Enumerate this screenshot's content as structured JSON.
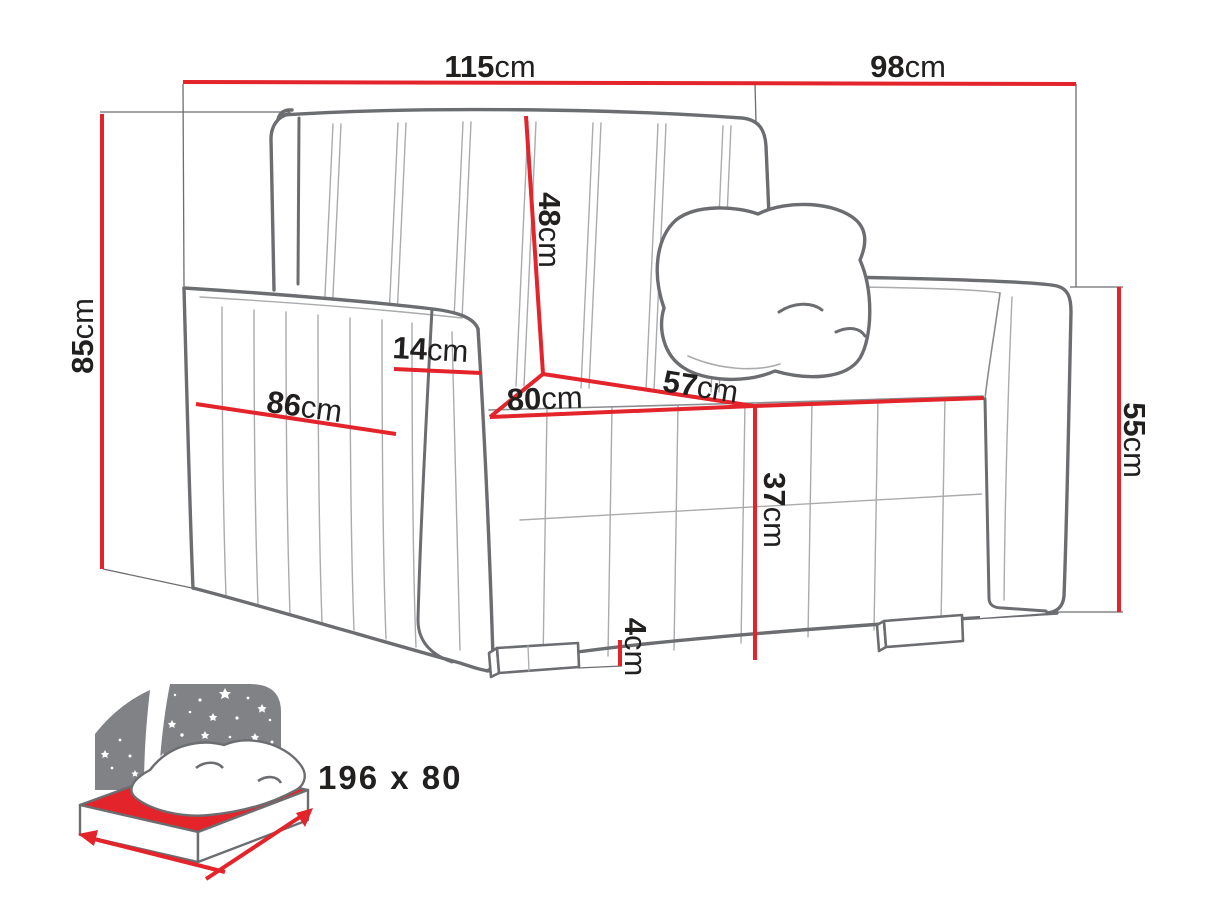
{
  "diagram": {
    "subject": "armchair sofa-bed dimension diagram",
    "unit": "cm",
    "colors": {
      "dimension_red": "#e3242b",
      "outline_gray": "#6b6d70",
      "sketch_gray": "#a9abad",
      "label_black": "#221f1f",
      "icon_gray": "#808285",
      "icon_text_gray": "#77787b"
    },
    "dimensions": {
      "overall_width": {
        "value": "115",
        "unit": "cm"
      },
      "overall_depth": {
        "value": "98",
        "unit": "cm"
      },
      "overall_height": {
        "value": "85",
        "unit": "cm"
      },
      "backrest_height": {
        "value": "48",
        "unit": "cm"
      },
      "armrest_width": {
        "value": "14",
        "unit": "cm"
      },
      "armrest_length": {
        "value": "86",
        "unit": "cm"
      },
      "seat_width": {
        "value": "80",
        "unit": "cm"
      },
      "seat_depth": {
        "value": "57",
        "unit": "cm"
      },
      "seat_height": {
        "value": "37",
        "unit": "cm"
      },
      "side_height": {
        "value": "55",
        "unit": "cm"
      },
      "leg_height": {
        "value": "4",
        "unit": "cm"
      }
    },
    "sleeping_area": {
      "value": "196 x 80"
    }
  }
}
